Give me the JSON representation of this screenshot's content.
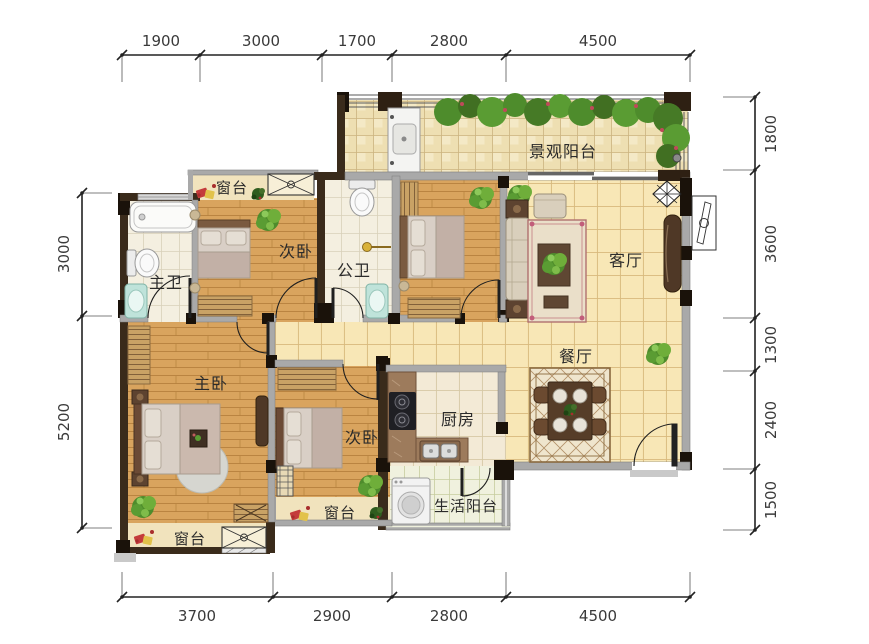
{
  "plan": {
    "rooms": {
      "view_balcony": "景观阳台",
      "living_room": "客厅",
      "dining_room": "餐厅",
      "kitchen": "厨房",
      "utility_balcony": "生活阳台",
      "master_bedroom": "主卧",
      "master_bath": "主卫",
      "public_bath": "公卫",
      "secondary_bedrooms": [
        "次卧",
        "次卧"
      ],
      "sills": [
        "窗台",
        "窗台",
        "窗台"
      ]
    },
    "dimensions": {
      "top": [
        "1900",
        "3000",
        "1700",
        "2800",
        "4500"
      ],
      "bottom": [
        "3700",
        "2900",
        "2800",
        "4500"
      ],
      "left": [
        "3000",
        "5200"
      ],
      "right": [
        "1800",
        "3600",
        "1300",
        "2400",
        "1500"
      ]
    },
    "colors": {
      "wall_dark": "#3a2b1b",
      "wall_black": "#1a120a",
      "wall_gray": "#aaaaaa",
      "tile_floor": "#f8e7b6",
      "wood_floor": "#d9a45e",
      "bath_tile": "#f4efe0",
      "balcony_tile": "#eedfb2",
      "greenery": "#4e8c2c",
      "dim_text": "#3a3a3a"
    }
  }
}
